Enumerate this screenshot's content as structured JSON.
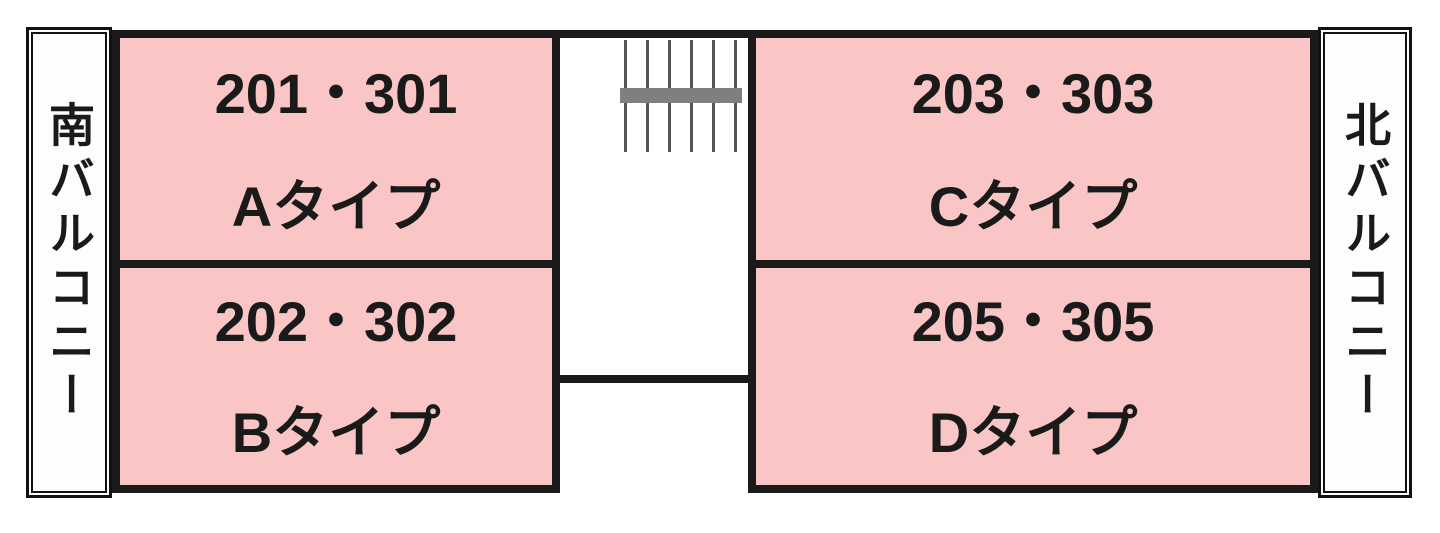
{
  "diagram": {
    "type": "floor-plan",
    "colors": {
      "room_fill": "#f9c6c5",
      "wall": "#1a1a1a",
      "stair_landing": "#7f7f7f",
      "background": "#ffffff"
    },
    "balconies": {
      "left": {
        "label": "南バルコニー"
      },
      "right": {
        "label": "北バルコニー"
      }
    },
    "rooms": [
      {
        "position": "top-left",
        "units": "201・301",
        "type": "Aタイプ"
      },
      {
        "position": "bottom-left",
        "units": "202・302",
        "type": "Bタイプ"
      },
      {
        "position": "top-right",
        "units": "203・303",
        "type": "Cタイプ"
      },
      {
        "position": "bottom-right",
        "units": "205・305",
        "type": "Dタイプ"
      }
    ],
    "stairs": {
      "icon": "staircase-icon"
    }
  }
}
